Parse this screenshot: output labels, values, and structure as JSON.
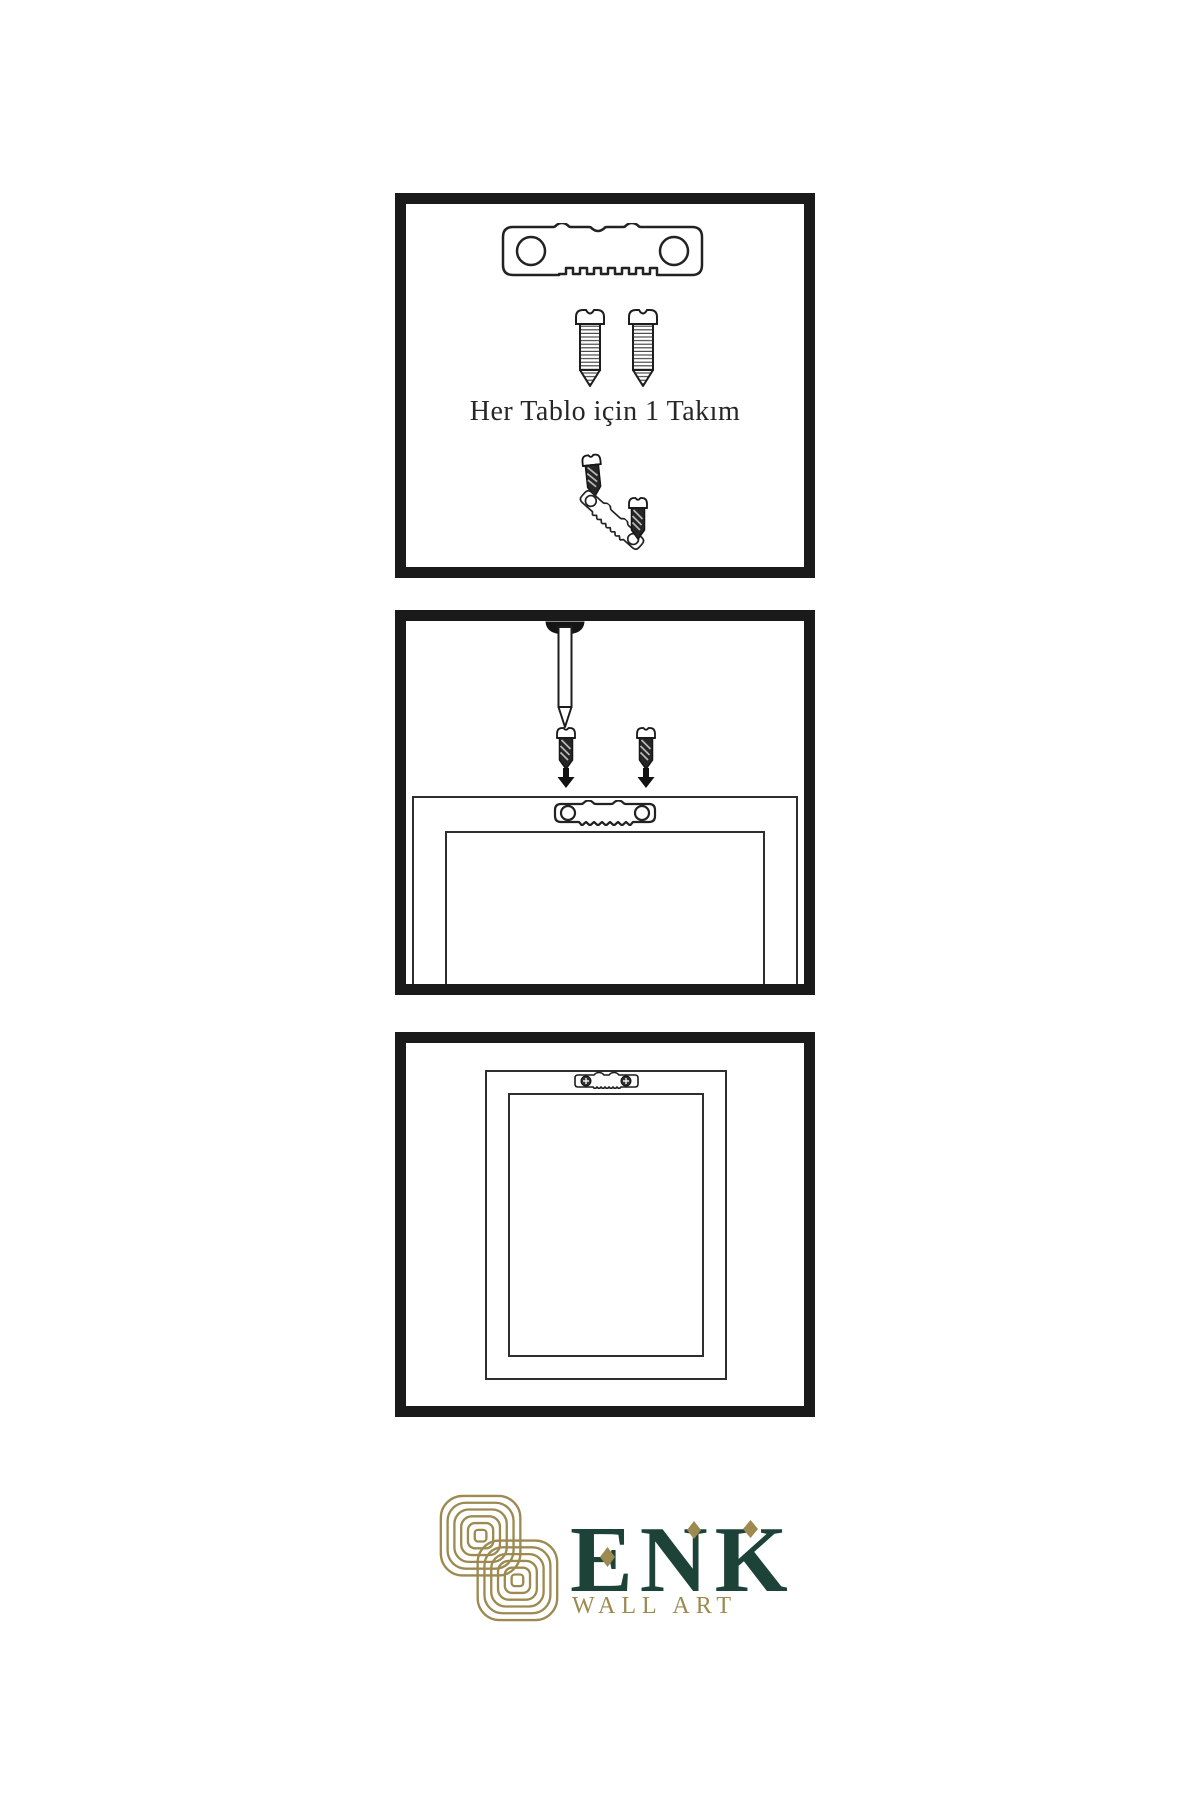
{
  "step1": {
    "caption": "Her Tablo için 1 Takım"
  },
  "logo": {
    "brand": "ENK",
    "subtitle": "WALL ART"
  },
  "colors": {
    "line": "#1a1a1a",
    "brand_green": "#1d4238",
    "brand_gold": "#9c8a50",
    "screw_dark": "#262626"
  },
  "icons": [
    "sawtooth-hanger-icon",
    "screw-icon",
    "dark-screw-icon",
    "wall-nail-icon",
    "down-arrow-icon",
    "frame-back-icon",
    "mounted-hanger-icon",
    "knot-logo-icon"
  ]
}
